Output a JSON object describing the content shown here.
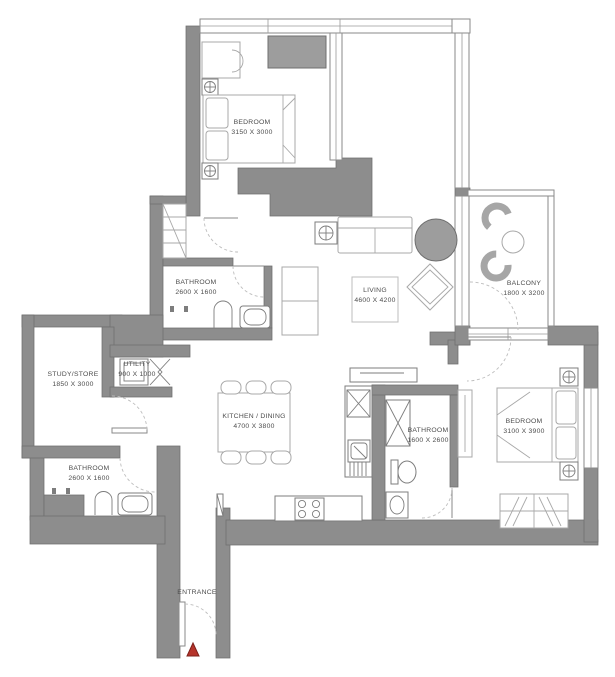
{
  "plan_type": "apartment-floor-plan",
  "rooms": {
    "bedroom1": {
      "name": "BEDROOM",
      "dims": "3150 X 3000"
    },
    "bathroom1": {
      "name": "BATHROOM",
      "dims": "2600 X 1600"
    },
    "living": {
      "name": "LIVING",
      "dims": "4600 X 4200"
    },
    "balcony": {
      "name": "BALCONY",
      "dims": "1800 X 3200"
    },
    "study": {
      "name": "STUDY/STORE",
      "dims": "1850 X 3000"
    },
    "utility": {
      "name": "UTILITY",
      "dims": "900 X 1000"
    },
    "kitchen": {
      "name": "KITCHEN / DINING",
      "dims": "4700 X 3800"
    },
    "bathroom2": {
      "name": "BATHROOM",
      "dims": "2600 X 1600"
    },
    "bathroom3": {
      "name": "BATHROOM",
      "dims": "1600 X 2600"
    },
    "bedroom2": {
      "name": "BEDROOM",
      "dims": "3100 X 3900"
    },
    "entrance": {
      "name": "ENTRANCE",
      "dims": ""
    }
  },
  "colors": {
    "wall": "#8d8d8d",
    "furniture_gray": "#9d9d9d",
    "entrance_marker": "#b5342b",
    "text": "#4d4d4d",
    "background": "#ffffff"
  }
}
